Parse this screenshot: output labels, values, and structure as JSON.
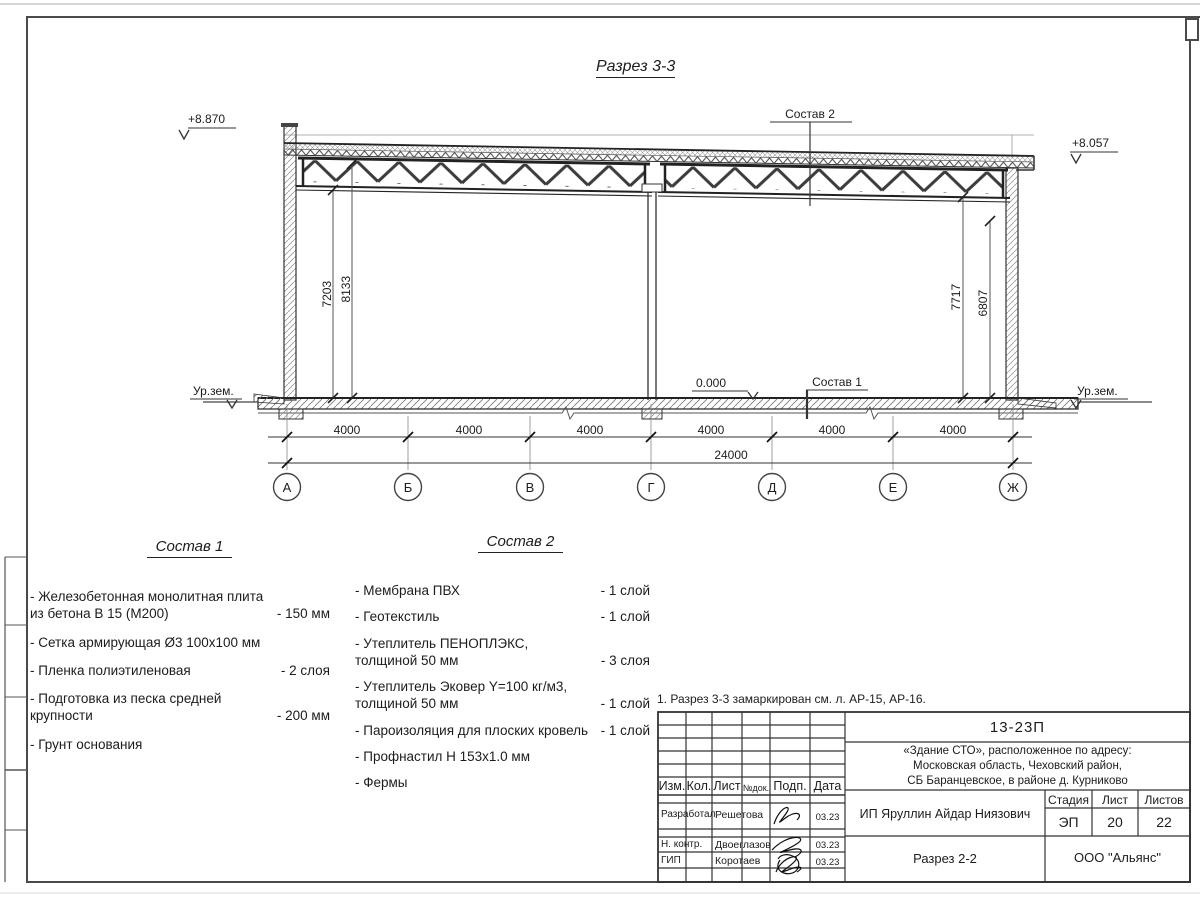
{
  "sheet": {
    "title": "Разрез 3-3",
    "note": "1. Разрез 3-3 замаркирован см. л. АР-15, АР-16."
  },
  "section": {
    "elev_left": "+8.870",
    "elev_right": "+8.057",
    "elev_zero": "0.000",
    "ground_left": "Ур.зем.",
    "ground_right": "Ур.зем.",
    "ref1_label": "Состав 1",
    "ref2_label": "Состав 2",
    "v_dims": {
      "left_inner": "7203",
      "left_outer": "8133",
      "right_inner": "7717",
      "right_outer": "6807"
    },
    "bay_dims": [
      "4000",
      "4000",
      "4000",
      "4000",
      "4000",
      "4000"
    ],
    "total_dim": "24000",
    "axes": [
      "А",
      "Б",
      "В",
      "Г",
      "Д",
      "Е",
      "Ж"
    ]
  },
  "sostav1": {
    "heading": "Состав 1",
    "items": [
      {
        "text": "- Железобетонная  монолитная плита\nиз бетона В 15 (М200)",
        "value": "- 150 мм"
      },
      {
        "text": "- Сетка армирующая Ø3 100х100 мм",
        "value": ""
      },
      {
        "text": "- Пленка полиэтиленовая",
        "value": "-  2 слоя"
      },
      {
        "text": "- Подготовка из песка средней\nкрупности",
        "value": "- 200 мм"
      },
      {
        "text": "- Грунт основания",
        "value": ""
      }
    ]
  },
  "sostav2": {
    "heading": "Состав 2",
    "items": [
      {
        "text": "- Мембрана ПВХ",
        "value": "- 1 слой"
      },
      {
        "text": "- Геотекстиль",
        "value": "- 1 слой"
      },
      {
        "text": "- Утеплитель ПЕНОПЛЭКС,\nтолщиной 50 мм",
        "value": "- 3 слоя"
      },
      {
        "text": "- Утеплитель Эковер Y=100 кг/м3,\nтолщиной 50 мм",
        "value": "- 1 слой"
      },
      {
        "text": "- Пароизоляция для плоских кровель",
        "value": "- 1 слой"
      },
      {
        "text": "- Профнастил Н 153х1.0 мм",
        "value": ""
      },
      {
        "text": "- Фермы",
        "value": ""
      }
    ]
  },
  "titleblock": {
    "doc_number": "13-23П",
    "project_address": "«Здание СТО», расположенное по адресу:\nМосковская область, Чеховский район,\nСБ Баранцевское, в районе д. Курниково",
    "client": "ИП Яруллин Айдар Ниязович",
    "sheet_name": "Разрез 2-2",
    "company": "ООО \"Альянс\"",
    "cols": {
      "izm": "Изм.",
      "kol": "Кол.",
      "list": "Лист",
      "doc": "№док.",
      "podp": "Подп.",
      "date": "Дата"
    },
    "stage_label": "Стадия",
    "list_label": "Лист",
    "listov_label": "Листов",
    "stage": "ЭП",
    "sheet_no": "20",
    "sheets_total": "22",
    "rows": [
      {
        "role": "Разработал",
        "name": "Решетова",
        "date": "03.23"
      },
      {
        "role": "Н. контр.",
        "name": "Двоеглазов",
        "date": "03.23"
      },
      {
        "role": "ГИП",
        "name": "Коротаев",
        "date": "03.23"
      }
    ]
  },
  "colors": {
    "line": "#333333",
    "paper": "#ffffff"
  }
}
